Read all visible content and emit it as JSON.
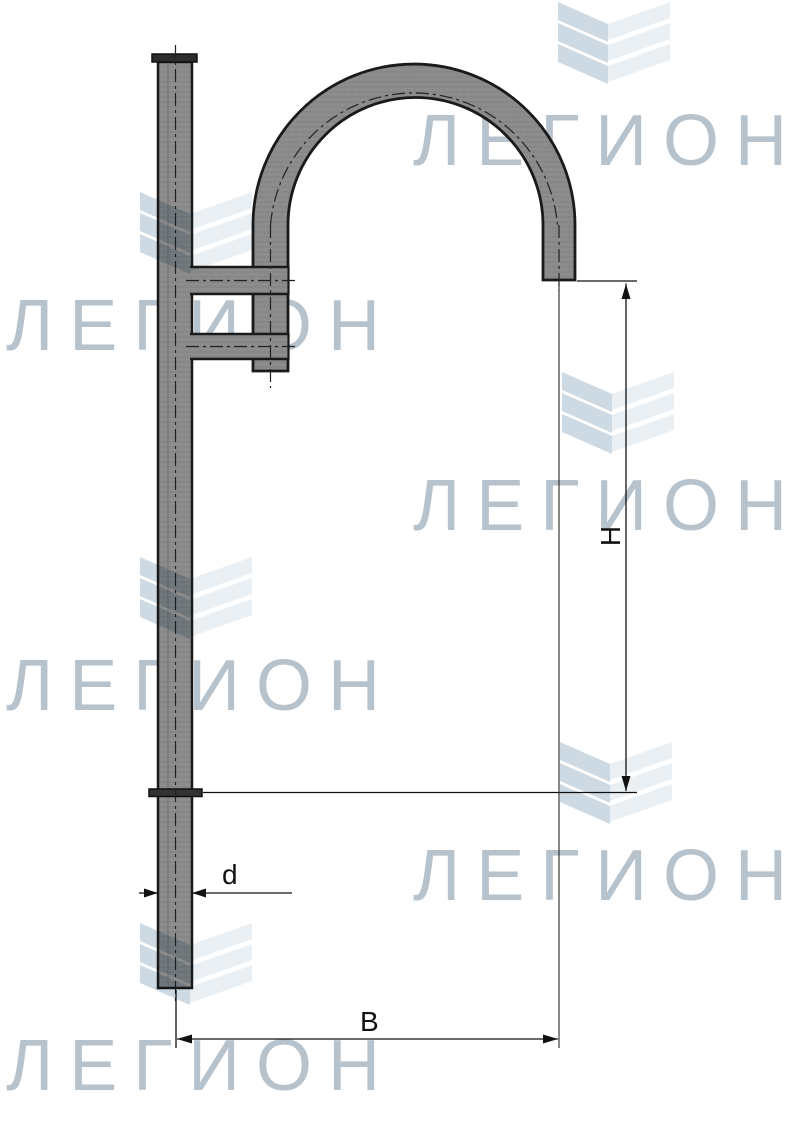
{
  "watermark": {
    "text": "ЛЕГИОН",
    "rows": [
      "ЛЕГИОН",
      "ЛЕГИОН",
      "ЛЕГИОН",
      "ЛЕГИОН",
      "ЛЕГИОН",
      "ЛЕГИОН"
    ],
    "text_color": "#b6c2cc",
    "logo": {
      "name": "chevron-logo",
      "dark_color": "#a3bccb",
      "light_color": "#d7e2e9"
    }
  },
  "dimensions": {
    "height_label": "H",
    "width_label": "B",
    "diameter_label": "d"
  },
  "drawing": {
    "kind": "technical drawing of a hooked pipe stand (ladder handrail / hook post)",
    "metal_fill": "#8d8d8d",
    "outline_color": "#1a1a1a"
  }
}
